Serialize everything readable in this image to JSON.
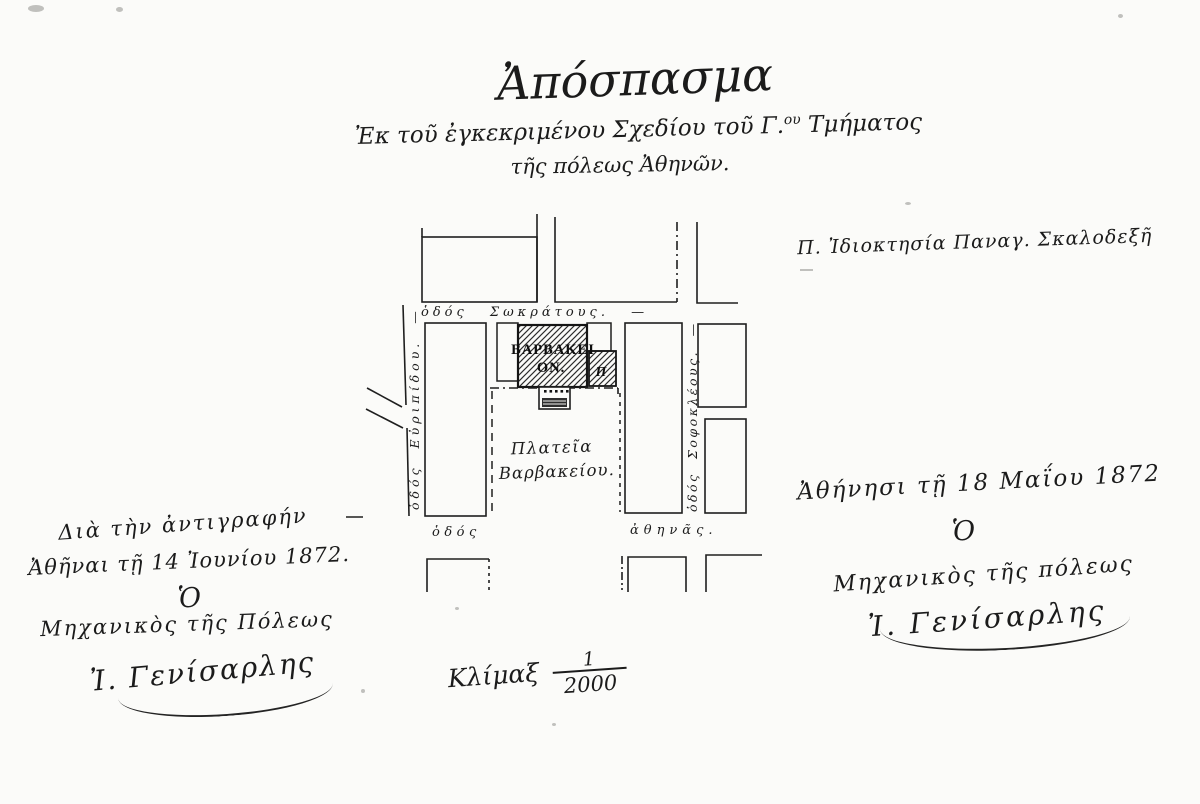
{
  "document": {
    "title": "Ἀπόσπασμα",
    "subtitle_pre": "Ἐκ τοῦ ἐγκεκριμένου Σχεδίου τοῦ Γ.",
    "subtitle_sup": "ου",
    "subtitle_post": " Τμήματος",
    "subtitle_line2": "τῆς πόλεως Ἀθηνῶν.",
    "annotation_right": "Π. Ἰδιοκτησία Παναγ. Σκαλοδεξῆ"
  },
  "map": {
    "streets": {
      "sokratous": "ὁδός Σωκράτους. —",
      "evripidou": "ὁδός Εὐριπίδου. —",
      "sofokleous": "ὁδός Σοφοκλέους. —",
      "athinas_odos": "ὁδός",
      "athinas_name": "ἀθηνᾶς."
    },
    "building": {
      "label_line1": "ΒΑΡΒΑΚΕΙ",
      "label_line2": "ΟΝ.",
      "plot_label": "Π"
    },
    "square": {
      "label_line1": "Πλατεῖα",
      "label_line2": "Βαρβακείου."
    }
  },
  "left_note": {
    "line1": "Διὰ τὴν ἀντιγραφήν",
    "line2": "Ἀθῆναι τῇ 14 Ἰουνίου 1872.",
    "article": "Ὁ",
    "line3": "Μηχανικὸς τῆς Πόλεως",
    "signature": "Ἰ. Γενίσαρλης"
  },
  "right_note": {
    "line1": "Ἀθήνησι τῇ 18 Μαΐου 1872",
    "article": "Ὁ",
    "line2": "Μηχανικὸς τῆς πόλεως",
    "signature": "Ἰ. Γενίσαρλης"
  },
  "scale": {
    "label": "Κλίμαξ",
    "numerator": "1",
    "denominator": "2000"
  },
  "colors": {
    "ink": "#1b1b1b",
    "paper": "#fbfbf9"
  }
}
